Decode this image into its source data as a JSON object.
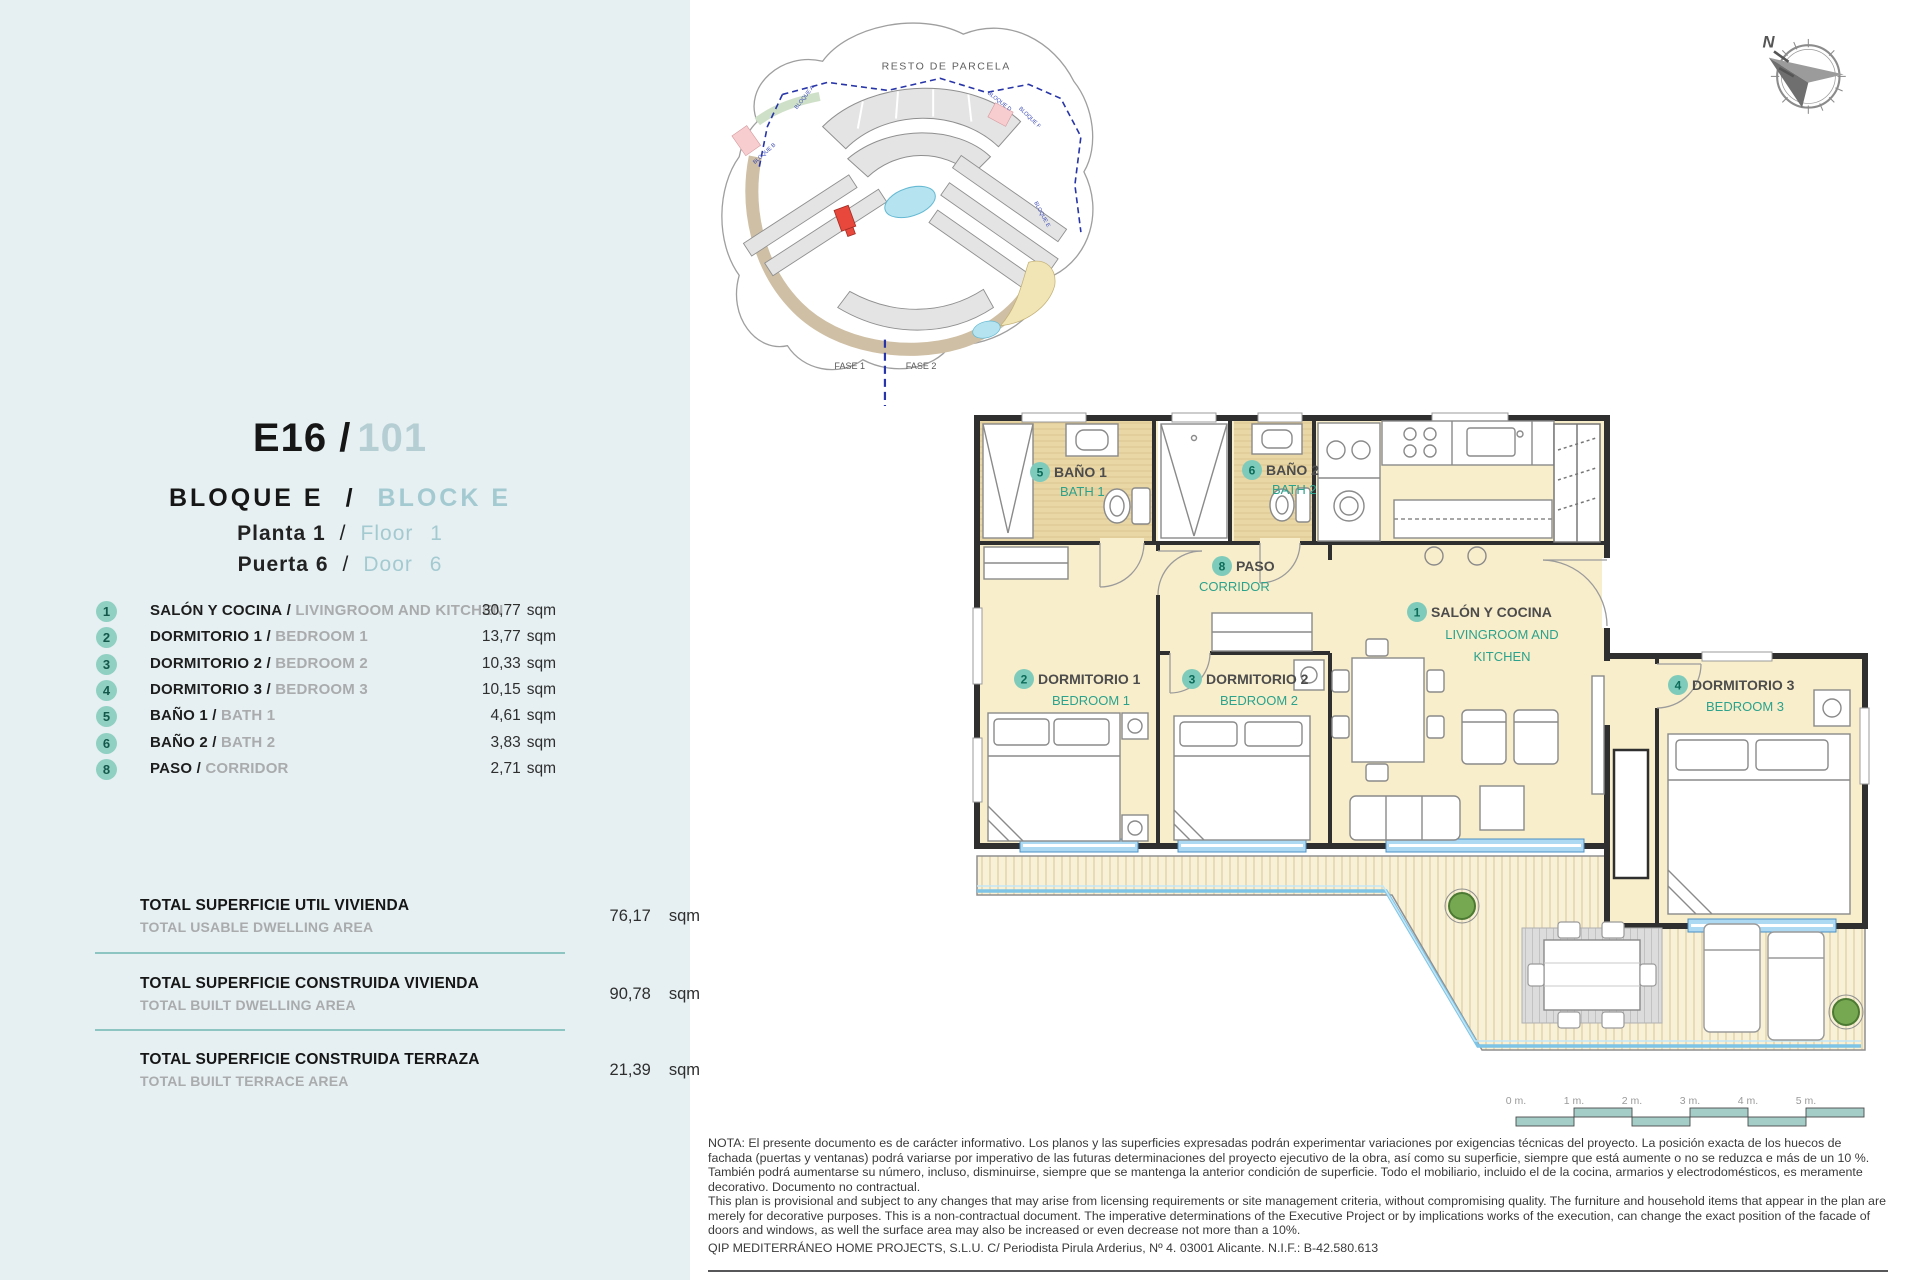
{
  "labels": {
    "sep": "/",
    "sqm": "sqm"
  },
  "header": {
    "code": "E16 /",
    "number": "101",
    "block_es": "BLOQUE E",
    "block_en": "BLOCK E",
    "floor_es": "Planta 1",
    "floor_en": "Floor  1",
    "door_es": "Puerta 6",
    "door_en": "Door  6"
  },
  "rooms": [
    {
      "num": "1",
      "es": "SALÓN Y COCINA",
      "en": "LIVINGROOM AND KITCHEN",
      "area": "30,77"
    },
    {
      "num": "2",
      "es": "DORMITORIO 1",
      "en": "BEDROOM 1",
      "area": "13,77"
    },
    {
      "num": "3",
      "es": "DORMITORIO 2",
      "en": "BEDROOM 2",
      "area": "10,33"
    },
    {
      "num": "4",
      "es": "DORMITORIO 3",
      "en": "BEDROOM 3",
      "area": "10,15"
    },
    {
      "num": "5",
      "es": "BAÑO 1",
      "en": "BATH 1",
      "area": "4,61"
    },
    {
      "num": "6",
      "es": "BAÑO 2",
      "en": "BATH 2",
      "area": "3,83"
    },
    {
      "num": "8",
      "es": "PASO",
      "en": "CORRIDOR",
      "area": "2,71"
    }
  ],
  "totals": [
    {
      "es": "TOTAL SUPERFICIE UTIL VIVIENDA",
      "en": "TOTAL USABLE DWELLING AREA",
      "value": "76,17"
    },
    {
      "es": "TOTAL SUPERFICIE CONSTRUIDA VIVIENDA",
      "en": "TOTAL BUILT DWELLING AREA",
      "value": "90,78"
    },
    {
      "es": "TOTAL SUPERFICIE CONSTRUIDA TERRAZA",
      "en": "TOTAL BUILT TERRACE AREA",
      "value": "21,39"
    }
  ],
  "plan_rooms": [
    {
      "num": "5",
      "es": "BAÑO 1",
      "en": "BATH 1"
    },
    {
      "num": "6",
      "es": "BAÑO 2",
      "en": "BATH 2"
    },
    {
      "num": "8",
      "es": "PASO",
      "en": "CORRIDOR"
    },
    {
      "num": "1",
      "es": "SALÓN Y COCINA",
      "en1": "LIVINGROOM AND",
      "en2": "KITCHEN"
    },
    {
      "num": "2",
      "es": "DORMITORIO 1",
      "en": "BEDROOM 1"
    },
    {
      "num": "3",
      "es": "DORMITORIO 2",
      "en": "BEDROOM 2"
    },
    {
      "num": "4",
      "es": "DORMITORIO 3",
      "en": "BEDROOM 3"
    }
  ],
  "site_plan": {
    "area_label": "RESTO DE PARCELA",
    "fase1": "FASE 1",
    "fase2": "FASE 2",
    "bloques": [
      "BLOQUE A",
      "BLOQUE B",
      "BLOQUE D",
      "BLOQUE F",
      "BLOQUE E"
    ]
  },
  "compass": {
    "north": "N"
  },
  "scale_bar": {
    "labels": [
      "0 m.",
      "1 m.",
      "2 m.",
      "3 m.",
      "4 m.",
      "5 m."
    ]
  },
  "note": {
    "es": "NOTA: El presente documento es de carácter informativo. Los planos y las superficies expresadas podrán experimentar variaciones por exigencias técnicas del proyecto. La posición exacta de los huecos de fachada (puertas y ventanas) podrá variarse por imperativo de las futuras determinaciones del proyecto ejecutivo de la obra, así como su superficie, siempre que está aumente o no se reduzca e más de un 10 %. También podrá aumentarse su número, incluso, disminuirse, siempre que se mantenga la anterior condición de superficie. Todo el mobiliario, incluido el de la cocina, armarios y electrodomésticos, es meramente decorativo. Documento no contractual.",
    "en": "This plan is provisional and subject to any changes that may arise from licensing requirements or site management criteria, without compromising quality. The furniture and household items that appear in the plan are merely for decorative purposes. This is a non-contractual document. The imperative determinations of the Executive Project or by implications works of the execution, can change the exact position of the facade of doors and windows, as well the surface area may also be increased or even decrease not more than a 10%.",
    "company": "QIP MEDITERRÁNEO HOME PROJECTS, S.L.U. C/ Periodista Pirula Arderius, Nº 4. 03001 Alicante. N.I.F.: B-42.580.613"
  },
  "colors": {
    "panel_bg": "#e6f0f2",
    "accent_teal": "#2ba28c",
    "light_teal": "#a4cad1",
    "badge_teal": "#8fd0c2",
    "floor_cream": "#f9eecb",
    "bath_tan": "#ead7a6",
    "glass_blue": "#aed9f2",
    "water_blue": "#7ec4e6",
    "unit_red": "#e8473c",
    "boundary_blue": "#2735a8",
    "divider_teal": "#8cc5c2"
  }
}
